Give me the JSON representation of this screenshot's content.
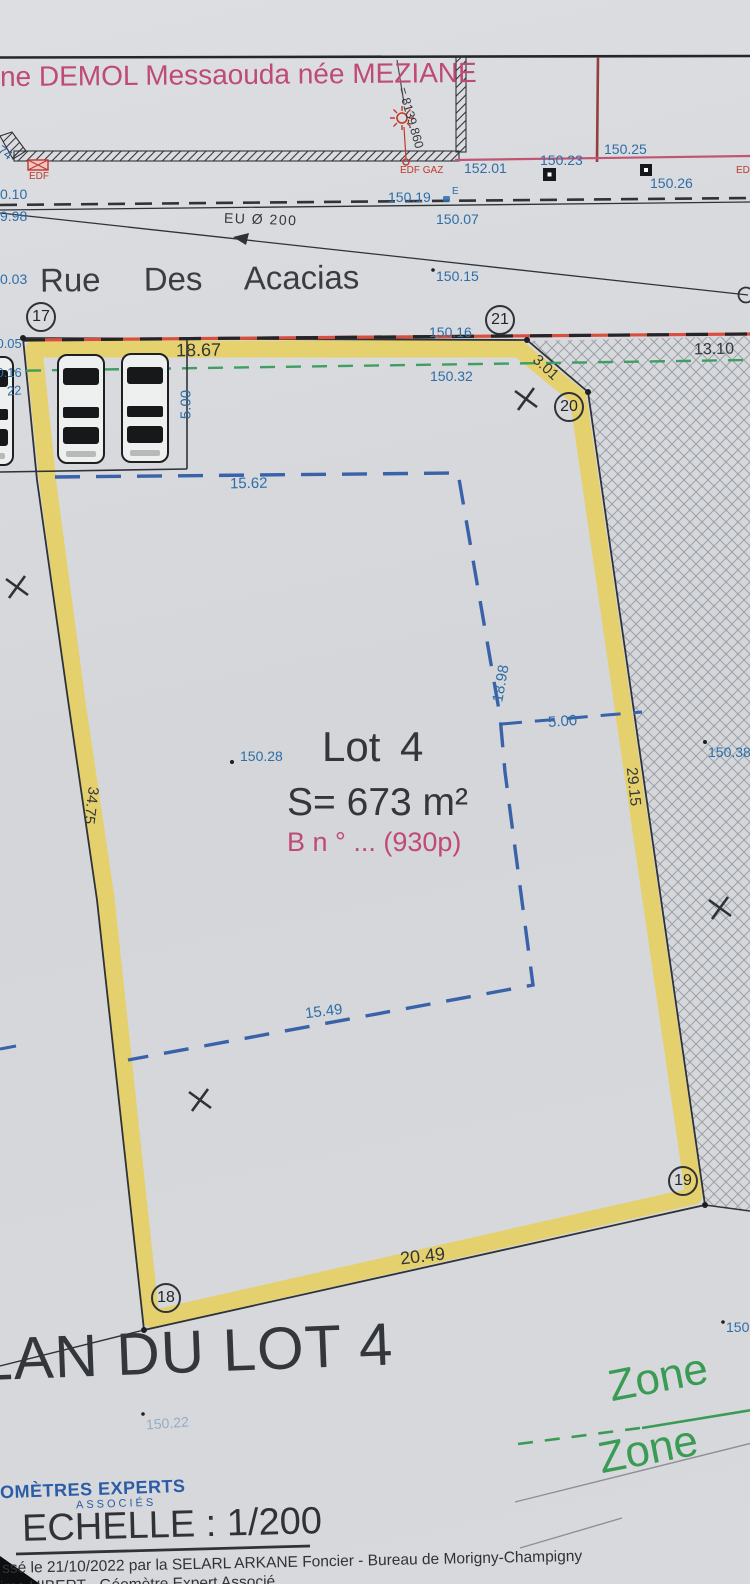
{
  "document": {
    "owner_name": "ne DEMOL Messaouda née MEZIANE",
    "plan_title": "PLAN DU LOT 4",
    "scale_label": "ECHELLE : 1/200",
    "logo_top": "OMÈTRES EXPERTS",
    "logo_bottom": "ASSOCIÉS",
    "footer_line1": "ssé le 21/10/2022 par la SELARL ARKANE Foncier - Bureau de Morigny-Champigny",
    "footer_line2": "ime HIBERT - Géomètre Expert Associé"
  },
  "street": {
    "name": "Rue Des Acacias",
    "sewer_label": "EU Ø 200",
    "benchmark": "= 8139.860",
    "ref_left": "74"
  },
  "utilities": {
    "edf_left": "EDF",
    "edf_gaz": "EDF GAZ",
    "edf_right": "EDF",
    "e_mark": "E"
  },
  "lot": {
    "name": "Lot 4",
    "area": "S= 673 m²",
    "parcel_ref": "B n ° ... (930p)"
  },
  "zones": {
    "zone_upper": "Zone",
    "zone_lower": "Zone"
  },
  "vertices": {
    "v17": "17",
    "v18": "18",
    "v19": "19",
    "v20": "20",
    "v21": "21"
  },
  "dimensions": {
    "boundary_top": "18.67",
    "boundary_cut": "3.01",
    "boundary_right": "29.15",
    "boundary_left": "34.75",
    "boundary_bottom": "20.49",
    "strip_right": "13.10",
    "setback_top": "15.62",
    "setback_side": "18.98",
    "setback_gap": "5.00",
    "setback_bottom": "15.49",
    "parking_depth": "5.00"
  },
  "elevations": {
    "e010": "0.10",
    "e998": "9.98",
    "e003": "0.03",
    "e15019": "150.19",
    "e15007": "150.07",
    "e15201": "152.01",
    "e15023": "150.23",
    "e15025": "150.25",
    "e15026": "150.26",
    "e15015": "150.15",
    "e15016": "150.16",
    "e15032": "150.32",
    "e5005": "150.05",
    "e5016": "150.16",
    "e22": "22",
    "e15028": "150.28",
    "e15038": "150.38",
    "e150": "150",
    "e15022": "150.22"
  },
  "colors": {
    "ink": "#2f3237",
    "measure_blue": "#2e6da8",
    "pink": "#bf4a74",
    "boundary_yellow": "#e8cf5a",
    "boundary_red": "#d94f3f",
    "green": "#3f9e62",
    "zone_green": "#3a9b55",
    "logo_blue": "#2b5ca5"
  }
}
